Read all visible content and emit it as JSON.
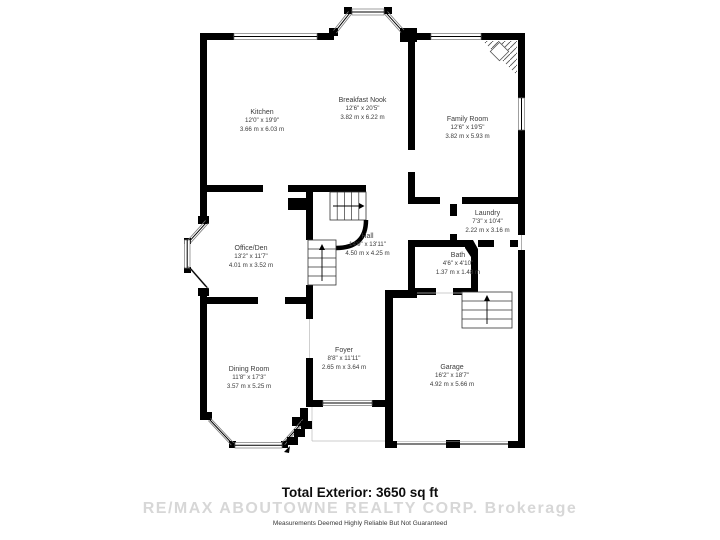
{
  "plan": {
    "rooms": [
      {
        "name": "Kitchen",
        "imperial": "12'0\" x 19'9\"",
        "metric": "3.66 m x 6.03 m"
      },
      {
        "name": "Breakfast Nook",
        "imperial": "12'6\" x 20'5\"",
        "metric": "3.82 m x 6.22 m"
      },
      {
        "name": "Family Room",
        "imperial": "12'6\" x 19'5\"",
        "metric": "3.82 m x 5.93 m"
      },
      {
        "name": "Laundry",
        "imperial": "7'3\" x 10'4\"",
        "metric": "2.22 m x 3.16 m"
      },
      {
        "name": "Hall",
        "imperial": "14'9\" x 13'11\"",
        "metric": "4.50 m x 4.25 m"
      },
      {
        "name": "Office/Den",
        "imperial": "13'2\" x 11'7\"",
        "metric": "4.01 m x 3.52 m"
      },
      {
        "name": "Bath",
        "imperial": "4'6\" x 4'10\"",
        "metric": "1.37 m x 1.48 m"
      },
      {
        "name": "Dining Room",
        "imperial": "11'8\" x 17'3\"",
        "metric": "3.57 m x 5.25 m"
      },
      {
        "name": "Foyer",
        "imperial": "8'8\" x 11'11\"",
        "metric": "2.65 m x 3.64 m"
      },
      {
        "name": "Garage",
        "imperial": "16'2\" x 18'7\"",
        "metric": "4.92 m x 5.66 m"
      }
    ],
    "footer": {
      "total": "Total Exterior: 3650 sq ft",
      "watermark": "RE/MAX ABOUTOWNE REALTY CORP.  Brokerage",
      "disclaimer": "Measurements Deemed Highly Reliable But Not Guaranteed"
    },
    "colors": {
      "wall": "#000000",
      "background": "#ffffff",
      "watermark": "#d7d7d7",
      "label_text": "#3b3b3b"
    }
  }
}
